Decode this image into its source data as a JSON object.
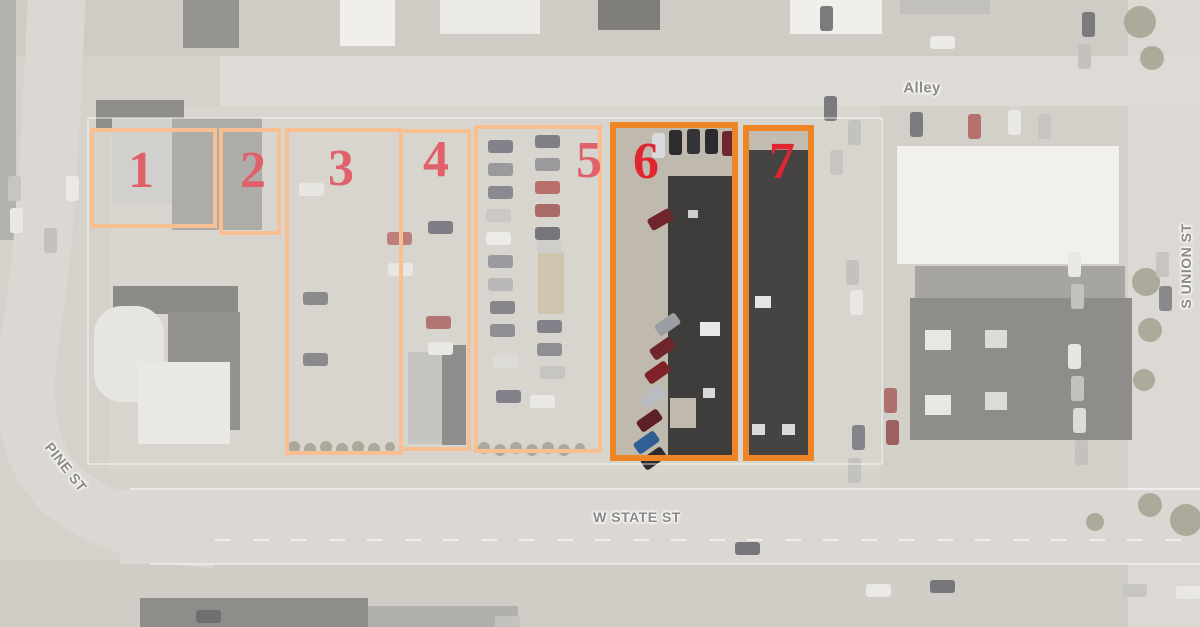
{
  "streets": {
    "alley": {
      "label": "Alley",
      "x": 922,
      "y": 88
    },
    "pine": {
      "label": "PINE ST",
      "x": 66,
      "y": 467
    },
    "w_state": {
      "label": "W STATE ST",
      "x": 637,
      "y": 517
    },
    "s_union": {
      "label": "S UNION ST",
      "x": 1186,
      "y": 266
    }
  },
  "parcels": [
    {
      "number": "1",
      "x": 90,
      "y": 128,
      "w": 127,
      "h": 100,
      "nx": 137,
      "ny": 168,
      "highlight": false
    },
    {
      "number": "2",
      "x": 219,
      "y": 128,
      "w": 62,
      "h": 107,
      "nx": 249,
      "ny": 168,
      "highlight": false
    },
    {
      "number": "3",
      "x": 285,
      "y": 128,
      "w": 118,
      "h": 327,
      "nx": 337,
      "ny": 166,
      "highlight": false
    },
    {
      "number": "4",
      "x": 399,
      "y": 129,
      "w": 72,
      "h": 322,
      "nx": 432,
      "ny": 157,
      "highlight": false
    },
    {
      "number": "5",
      "x": 474,
      "y": 125,
      "w": 128,
      "h": 328,
      "nx": 585,
      "ny": 158,
      "highlight": false
    },
    {
      "number": "6",
      "x": 610,
      "y": 122,
      "w": 128,
      "h": 339,
      "nx": 640,
      "ny": 157,
      "highlight": true
    },
    {
      "number": "7",
      "x": 743,
      "y": 125,
      "w": 71,
      "h": 336,
      "nx": 776,
      "ny": 157,
      "highlight": true
    }
  ],
  "colors": {
    "parcel_border_light": "#f8bf92",
    "parcel_border_highlight": "#ee8527",
    "parcel_number_light": "#e0616a",
    "parcel_number_highlight": "#e02630",
    "street_label": "#8a8987",
    "base_ground": "#d5d2cc"
  },
  "aerial": {
    "ground": [
      {
        "x": 0,
        "y": 0,
        "w": 1200,
        "h": 56,
        "c": "#cfccc6"
      },
      {
        "x": 0,
        "y": 560,
        "w": 1200,
        "h": 67,
        "c": "#d0cdc7"
      },
      {
        "x": 110,
        "y": 106,
        "w": 772,
        "h": 366,
        "c": "#d8d5cf"
      },
      {
        "x": 880,
        "y": 110,
        "w": 250,
        "h": 372,
        "c": "#d3d0ca"
      },
      {
        "x": 1128,
        "y": 0,
        "w": 72,
        "h": 627,
        "c": "#dcd9d4"
      },
      {
        "x": 220,
        "y": 56,
        "w": 980,
        "h": 50,
        "c": "#dedbd6"
      },
      {
        "x": 120,
        "y": 490,
        "w": 1080,
        "h": 74,
        "c": "#dbd8d3"
      },
      {
        "x": 0,
        "y": 0,
        "w": 16,
        "h": 240,
        "c": "#b4b2ae"
      },
      {
        "x": 538,
        "y": 252,
        "w": 26,
        "h": 62,
        "c": "#cfc4ae"
      },
      {
        "x": 612,
        "y": 124,
        "w": 124,
        "h": 335,
        "c": "#c0b9ad"
      },
      {
        "x": 745,
        "y": 127,
        "w": 67,
        "h": 332,
        "c": "#c3bcb0"
      }
    ],
    "pine_road_path": "M 57,-10 C 50,150 45,250 30,340 C 18,420 30,480 95,512 C 130,528 165,536 215,539",
    "pine_road_width": 58,
    "pine_road_color": "#dbd8d3",
    "buildings": [
      {
        "x": 96,
        "y": 100,
        "w": 88,
        "h": 30,
        "c": "#8f8e8b"
      },
      {
        "x": 183,
        "y": 0,
        "w": 56,
        "h": 48,
        "c": "#96948f"
      },
      {
        "x": 340,
        "y": 0,
        "w": 55,
        "h": 46,
        "c": "#f0efeb"
      },
      {
        "x": 440,
        "y": 0,
        "w": 100,
        "h": 34,
        "c": "#eceae6"
      },
      {
        "x": 598,
        "y": 0,
        "w": 62,
        "h": 30,
        "c": "#7f7e7b"
      },
      {
        "x": 790,
        "y": 0,
        "w": 92,
        "h": 34,
        "c": "#f0efeb"
      },
      {
        "x": 900,
        "y": 0,
        "w": 90,
        "h": 14,
        "c": "#c2c0bc"
      },
      {
        "x": 112,
        "y": 118,
        "w": 62,
        "h": 86,
        "c": "#d2d0cc"
      },
      {
        "x": 172,
        "y": 118,
        "w": 90,
        "h": 112,
        "c": "#aeaca9"
      },
      {
        "x": 113,
        "y": 286,
        "w": 125,
        "h": 28,
        "c": "#8c8b88"
      },
      {
        "x": 168,
        "y": 312,
        "w": 72,
        "h": 118,
        "c": "#93928f"
      },
      {
        "x": 94,
        "y": 306,
        "w": 70,
        "h": 96,
        "c": "#e6e5e1",
        "r": 28
      },
      {
        "x": 138,
        "y": 362,
        "w": 92,
        "h": 82,
        "c": "#e9e8e4"
      },
      {
        "x": 408,
        "y": 352,
        "w": 34,
        "h": 92,
        "c": "#c6c4c0"
      },
      {
        "x": 442,
        "y": 345,
        "w": 24,
        "h": 100,
        "c": "#8f8e8c"
      },
      {
        "x": 897,
        "y": 146,
        "w": 222,
        "h": 118,
        "c": "#f1f0ec"
      },
      {
        "x": 915,
        "y": 266,
        "w": 210,
        "h": 34,
        "c": "#a7a5a1"
      },
      {
        "x": 910,
        "y": 298,
        "w": 222,
        "h": 142,
        "c": "#8e8d8a"
      },
      {
        "x": 925,
        "y": 330,
        "w": 26,
        "h": 20,
        "c": "#e8e7e3"
      },
      {
        "x": 925,
        "y": 395,
        "w": 26,
        "h": 20,
        "c": "#e8e7e3"
      },
      {
        "x": 985,
        "y": 330,
        "w": 22,
        "h": 18,
        "c": "#dcdbd7"
      },
      {
        "x": 985,
        "y": 392,
        "w": 22,
        "h": 18,
        "c": "#dcdbd7"
      },
      {
        "x": 140,
        "y": 598,
        "w": 228,
        "h": 29,
        "c": "#8e8d8a"
      },
      {
        "x": 368,
        "y": 606,
        "w": 150,
        "h": 21,
        "c": "#b2b0ac"
      },
      {
        "x": 668,
        "y": 176,
        "w": 70,
        "h": 284,
        "c": "#3e3d3b"
      },
      {
        "x": 670,
        "y": 398,
        "w": 26,
        "h": 30,
        "c": "#c0b9ad"
      },
      {
        "x": 700,
        "y": 322,
        "w": 20,
        "h": 14,
        "c": "#e8e8e8"
      },
      {
        "x": 703,
        "y": 388,
        "w": 12,
        "h": 10,
        "c": "#d8d8d8"
      },
      {
        "x": 688,
        "y": 210,
        "w": 10,
        "h": 8,
        "c": "#cfcfcf"
      },
      {
        "x": 747,
        "y": 150,
        "w": 62,
        "h": 308,
        "c": "#454442"
      },
      {
        "x": 755,
        "y": 296,
        "w": 16,
        "h": 12,
        "c": "#e4e4e4"
      },
      {
        "x": 752,
        "y": 424,
        "w": 13,
        "h": 11,
        "c": "#dadada"
      },
      {
        "x": 782,
        "y": 424,
        "w": 13,
        "h": 11,
        "c": "#dadada"
      }
    ],
    "cars": [
      {
        "x": 299,
        "y": 183,
        "o": "h",
        "c": "#e7e6e3"
      },
      {
        "x": 387,
        "y": 232,
        "o": "h",
        "c": "#bd7f7a"
      },
      {
        "x": 388,
        "y": 263,
        "o": "h",
        "c": "#e7e6e3"
      },
      {
        "x": 303,
        "y": 292,
        "o": "h",
        "c": "#8b8a8c"
      },
      {
        "x": 303,
        "y": 353,
        "o": "h",
        "c": "#8b8a8c"
      },
      {
        "x": 428,
        "y": 221,
        "o": "h",
        "c": "#7e7d85"
      },
      {
        "x": 426,
        "y": 316,
        "o": "h",
        "c": "#b27572"
      },
      {
        "x": 428,
        "y": 342,
        "o": "h",
        "c": "#e9e8e5"
      },
      {
        "x": 488,
        "y": 140,
        "o": "h",
        "c": "#83828a"
      },
      {
        "x": 488,
        "y": 163,
        "o": "h",
        "c": "#9a999c"
      },
      {
        "x": 488,
        "y": 186,
        "o": "h",
        "c": "#8a8a90"
      },
      {
        "x": 486,
        "y": 209,
        "o": "h",
        "c": "#c9c8c5"
      },
      {
        "x": 486,
        "y": 232,
        "o": "h",
        "c": "#ecebe8"
      },
      {
        "x": 488,
        "y": 255,
        "o": "h",
        "c": "#9b9a9e"
      },
      {
        "x": 488,
        "y": 278,
        "o": "h",
        "c": "#b9b8b6"
      },
      {
        "x": 490,
        "y": 301,
        "o": "h",
        "c": "#87868c"
      },
      {
        "x": 490,
        "y": 324,
        "o": "h",
        "c": "#8f8e92"
      },
      {
        "x": 493,
        "y": 355,
        "o": "h",
        "c": "#dcdbd8"
      },
      {
        "x": 496,
        "y": 390,
        "o": "h",
        "c": "#83828a"
      },
      {
        "x": 535,
        "y": 135,
        "o": "h",
        "c": "#807f84"
      },
      {
        "x": 535,
        "y": 158,
        "o": "h",
        "c": "#9a999c"
      },
      {
        "x": 535,
        "y": 181,
        "o": "h",
        "c": "#bb6f6b"
      },
      {
        "x": 535,
        "y": 204,
        "o": "h",
        "c": "#a96a68"
      },
      {
        "x": 535,
        "y": 227,
        "o": "h",
        "c": "#77767a"
      },
      {
        "x": 537,
        "y": 240,
        "o": "h",
        "c": "#cfcecb"
      },
      {
        "x": 537,
        "y": 320,
        "o": "h",
        "c": "#83828a"
      },
      {
        "x": 537,
        "y": 343,
        "o": "h",
        "c": "#8f8e92"
      },
      {
        "x": 540,
        "y": 366,
        "o": "h",
        "c": "#c6c5c2"
      },
      {
        "x": 530,
        "y": 395,
        "o": "h",
        "c": "#e9e8e5"
      },
      {
        "x": 652,
        "y": 133,
        "o": "v",
        "c": "#d9dadb"
      },
      {
        "x": 669,
        "y": 130,
        "o": "v",
        "c": "#2c2b2d"
      },
      {
        "x": 687,
        "y": 129,
        "o": "v",
        "c": "#343336"
      },
      {
        "x": 705,
        "y": 129,
        "o": "v",
        "c": "#2c2b2d"
      },
      {
        "x": 722,
        "y": 131,
        "o": "v",
        "c": "#6e2730"
      },
      {
        "x": 648,
        "y": 213,
        "o": "h",
        "a": -30,
        "c": "#6e262b"
      },
      {
        "x": 655,
        "y": 318,
        "o": "h",
        "a": -35,
        "c": "#9b9ea3"
      },
      {
        "x": 650,
        "y": 342,
        "o": "h",
        "a": -35,
        "c": "#6e262b"
      },
      {
        "x": 645,
        "y": 366,
        "o": "h",
        "a": -35,
        "c": "#7e2228"
      },
      {
        "x": 641,
        "y": 390,
        "o": "h",
        "a": -35,
        "c": "#b9bcc1"
      },
      {
        "x": 637,
        "y": 414,
        "o": "h",
        "a": -35,
        "c": "#5d2026"
      },
      {
        "x": 634,
        "y": 436,
        "o": "h",
        "a": -35,
        "c": "#2f5f93"
      },
      {
        "x": 641,
        "y": 452,
        "o": "h",
        "a": -35,
        "c": "#2c2b2d"
      },
      {
        "x": 824,
        "y": 96,
        "o": "v",
        "c": "#7b7a7c"
      },
      {
        "x": 848,
        "y": 120,
        "o": "v",
        "c": "#c3c2bf"
      },
      {
        "x": 830,
        "y": 150,
        "o": "v",
        "c": "#c6c5c2"
      },
      {
        "x": 846,
        "y": 260,
        "o": "v",
        "c": "#c3c2bf"
      },
      {
        "x": 850,
        "y": 290,
        "o": "v",
        "c": "#e9e8e5"
      },
      {
        "x": 852,
        "y": 425,
        "o": "v",
        "c": "#85848a"
      },
      {
        "x": 848,
        "y": 458,
        "o": "v",
        "c": "#c3c2bf"
      },
      {
        "x": 884,
        "y": 388,
        "o": "v",
        "c": "#b0706d"
      },
      {
        "x": 886,
        "y": 420,
        "o": "v",
        "c": "#9c605f"
      },
      {
        "x": 820,
        "y": 6,
        "o": "v",
        "c": "#7b7a7c"
      },
      {
        "x": 930,
        "y": 36,
        "o": "h",
        "c": "#eceae7"
      },
      {
        "x": 1082,
        "y": 12,
        "o": "v",
        "c": "#7b7a7c"
      },
      {
        "x": 1078,
        "y": 44,
        "o": "v",
        "c": "#c3c2bf"
      },
      {
        "x": 910,
        "y": 112,
        "o": "v",
        "c": "#7b7a7c"
      },
      {
        "x": 968,
        "y": 114,
        "o": "v",
        "c": "#b4716e"
      },
      {
        "x": 1008,
        "y": 110,
        "o": "v",
        "c": "#e9e8e5"
      },
      {
        "x": 1038,
        "y": 114,
        "o": "v",
        "c": "#c6c5c2"
      },
      {
        "x": 1068,
        "y": 252,
        "o": "v",
        "c": "#e9e8e5"
      },
      {
        "x": 1071,
        "y": 284,
        "o": "v",
        "c": "#c3c2bf"
      },
      {
        "x": 1068,
        "y": 344,
        "o": "v",
        "c": "#e7e6e3"
      },
      {
        "x": 1071,
        "y": 376,
        "o": "v",
        "c": "#c3c2bf"
      },
      {
        "x": 1073,
        "y": 408,
        "o": "v",
        "c": "#dcdbd8"
      },
      {
        "x": 1075,
        "y": 440,
        "o": "v",
        "c": "#c3c2bf"
      },
      {
        "x": 1156,
        "y": 252,
        "o": "v",
        "c": "#c6c5c2"
      },
      {
        "x": 1159,
        "y": 286,
        "o": "v",
        "c": "#8a898c"
      },
      {
        "x": 735,
        "y": 542,
        "o": "h",
        "c": "#77767a"
      },
      {
        "x": 196,
        "y": 610,
        "o": "h",
        "c": "#6f6e71"
      },
      {
        "x": 495,
        "y": 616,
        "o": "h",
        "c": "#c3c2bf"
      },
      {
        "x": 866,
        "y": 584,
        "o": "h",
        "c": "#eae9e6"
      },
      {
        "x": 930,
        "y": 580,
        "o": "h",
        "c": "#77767a"
      },
      {
        "x": 1122,
        "y": 584,
        "o": "h",
        "c": "#c6c5c2"
      },
      {
        "x": 1176,
        "y": 586,
        "o": "h",
        "c": "#e9e8e5"
      },
      {
        "x": 8,
        "y": 176,
        "o": "v",
        "c": "#c6c5c2"
      },
      {
        "x": 10,
        "y": 208,
        "o": "v",
        "c": "#e9e8e5"
      },
      {
        "x": 44,
        "y": 228,
        "o": "v",
        "c": "#c3c2bf"
      },
      {
        "x": 66,
        "y": 176,
        "o": "v",
        "c": "#eae9e6"
      }
    ],
    "trees": [
      {
        "x": 294,
        "y": 447,
        "r": 6
      },
      {
        "x": 310,
        "y": 449,
        "r": 6
      },
      {
        "x": 326,
        "y": 447,
        "r": 6
      },
      {
        "x": 342,
        "y": 449,
        "r": 6
      },
      {
        "x": 358,
        "y": 447,
        "r": 6
      },
      {
        "x": 374,
        "y": 449,
        "r": 6
      },
      {
        "x": 390,
        "y": 447,
        "r": 5
      },
      {
        "x": 484,
        "y": 448,
        "r": 6
      },
      {
        "x": 500,
        "y": 450,
        "r": 6
      },
      {
        "x": 516,
        "y": 448,
        "r": 6
      },
      {
        "x": 532,
        "y": 450,
        "r": 6
      },
      {
        "x": 548,
        "y": 448,
        "r": 6
      },
      {
        "x": 564,
        "y": 450,
        "r": 6
      },
      {
        "x": 580,
        "y": 448,
        "r": 5
      },
      {
        "x": 1140,
        "y": 22,
        "r": 16
      },
      {
        "x": 1152,
        "y": 58,
        "r": 12
      },
      {
        "x": 1146,
        "y": 282,
        "r": 14
      },
      {
        "x": 1150,
        "y": 330,
        "r": 12
      },
      {
        "x": 1144,
        "y": 380,
        "r": 11
      },
      {
        "x": 1150,
        "y": 505,
        "r": 12
      },
      {
        "x": 1186,
        "y": 520,
        "r": 16
      },
      {
        "x": 1095,
        "y": 522,
        "r": 9
      }
    ],
    "tree_color": "#a5a191",
    "lines": [
      {
        "x1": 130,
        "y1": 489,
        "x2": 1200,
        "y2": 489,
        "w": 2,
        "c": "rgba(255,255,255,0.55)"
      },
      {
        "x1": 150,
        "y1": 564,
        "x2": 1200,
        "y2": 564,
        "w": 2,
        "c": "rgba(255,255,255,0.45)"
      },
      {
        "x1": 215,
        "y1": 540,
        "x2": 1200,
        "y2": 540,
        "w": 2,
        "c": "rgba(255,255,255,0.55)",
        "dash": "16 22"
      },
      {
        "x1": 88,
        "y1": 118,
        "x2": 882,
        "y2": 118,
        "w": 1.5,
        "c": "rgba(255,255,255,0.55)"
      },
      {
        "x1": 882,
        "y1": 118,
        "x2": 882,
        "y2": 464,
        "w": 1.5,
        "c": "rgba(255,255,255,0.55)"
      },
      {
        "x1": 88,
        "y1": 464,
        "x2": 882,
        "y2": 464,
        "w": 1.5,
        "c": "rgba(255,255,255,0.55)"
      },
      {
        "x1": 88,
        "y1": 118,
        "x2": 88,
        "y2": 464,
        "w": 1.5,
        "c": "rgba(255,255,255,0.55)"
      }
    ]
  }
}
